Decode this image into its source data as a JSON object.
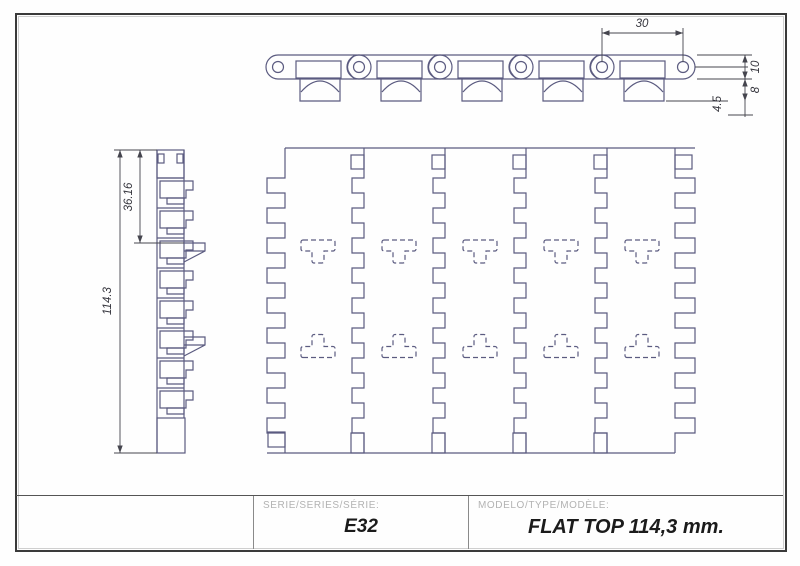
{
  "document": {
    "type": "technical-drawing",
    "product": "conveyor chain flat top module"
  },
  "dims": {
    "pitch": "30",
    "plate_thickness": "10",
    "foot_height": "8",
    "foot_width": "4.5",
    "top_section": "36.16",
    "overall_width": "114.3"
  },
  "title_block": {
    "series_label": "SERIE/SERIES/SÉRIE:",
    "series_value": "E32",
    "model_label": "MODELO/TYPE/MODÈLE:",
    "model_value": "FLAT TOP 114,3 mm."
  },
  "colors": {
    "geometry": "#5b5b80",
    "dimension": "#45454e",
    "frame": "#3a3a3a",
    "label_gray": "#b2b2b2",
    "value_black": "#1b1b1b"
  }
}
